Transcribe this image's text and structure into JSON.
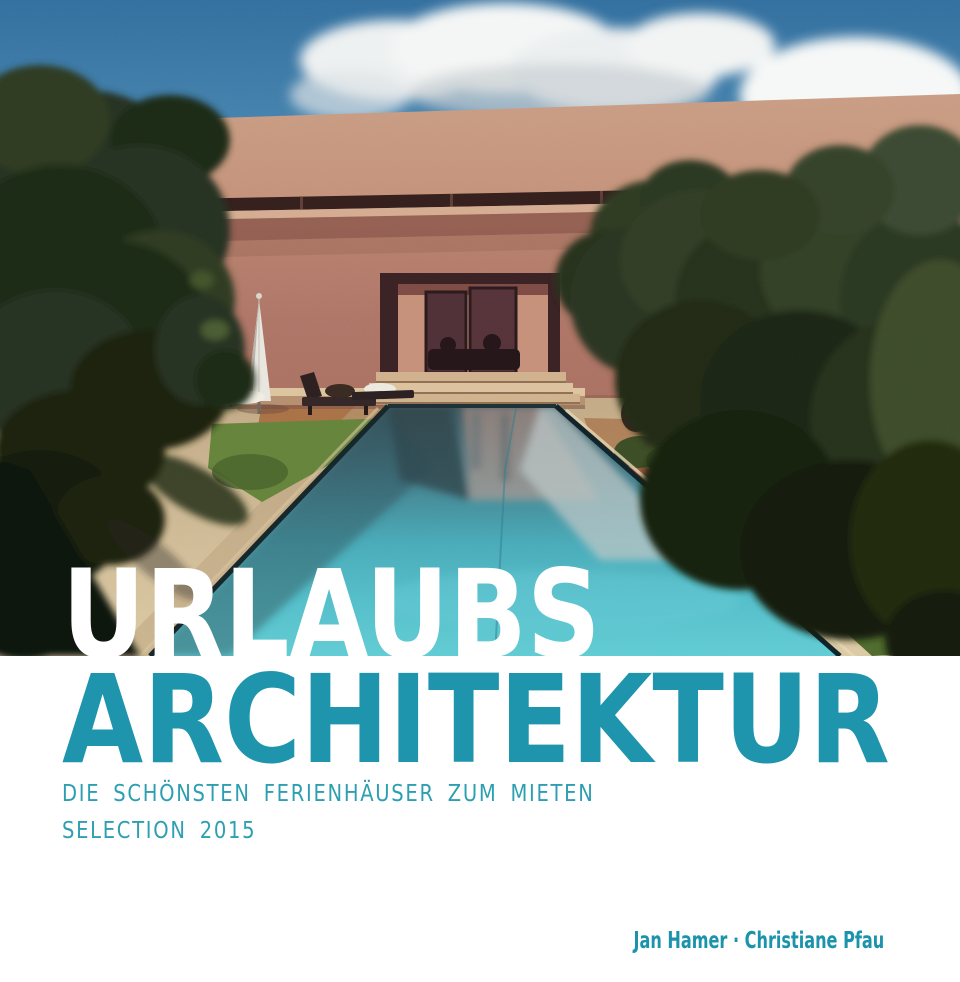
{
  "cover": {
    "title_line1": "URLAUBS",
    "title_line2": "ARCHITEKTUR",
    "subtitle": "DIE SCHÖNSTEN FERIENHÄUSER ZUM MIETEN",
    "edition_line": "SELECTION 2015",
    "authors": "Jan Hamer · Christiane Pfau"
  },
  "colors": {
    "title_line1": "#ffffff",
    "title_line2": "#1e95ac",
    "subtitle": "#2d9fb1",
    "authors": "#1a93ab",
    "background": "#ffffff",
    "sky": "#3d7aa6",
    "house_wall": "#b8806e",
    "pool_water": "#4db2c0",
    "stone_deck": "#cdb690",
    "olive_trees": "#2b3720"
  },
  "photo": {
    "alt": "Modern terracotta villa with a long turquoise lap pool, olive trees, a closed white parasol and sun loungers under a blue sky with clouds"
  }
}
